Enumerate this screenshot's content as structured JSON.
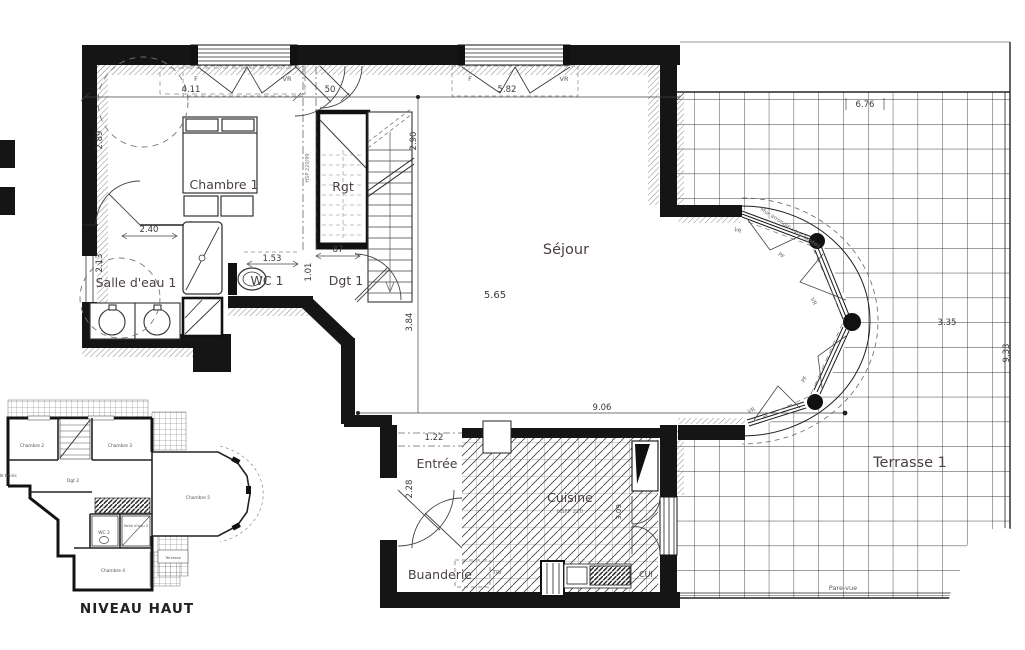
{
  "plan": {
    "rooms": {
      "chambre1": "Chambre 1",
      "rgt": "Rgt",
      "salle_eau": "Salle d'eau 1",
      "wc1": "WC 1",
      "dgt1": "Dgt 1",
      "sejour": "Séjour",
      "entree": "Entrée",
      "cuisine": "Cuisine",
      "buanderie": "Buanderie",
      "terrasse": "Terrasse 1"
    },
    "labels": {
      "hsfp": "HSFP 220",
      "tri": "TRI",
      "cui": "CUI",
      "pare_vue": "Pare-vue",
      "mur_arrondi": "Mur arrondie sans tapées",
      "hsp": "HSP 220/99",
      "f": "F",
      "vr": "VR",
      "pf": "PF"
    },
    "dims": {
      "w1": "4.11",
      "w2": "50",
      "w3": "5.82",
      "t1": "6.76",
      "left1": "2.89",
      "left2": "2.13",
      "sde": "2.40",
      "wc": "1.53",
      "dgt_w": "87",
      "dgt_h": "1.01",
      "stair": "2.90",
      "sej_h": "3.84",
      "sej_w": "5.65",
      "sej_b": "9.06",
      "ent_w": "1.22",
      "ent_h": "2.28",
      "cui_h": "3.09",
      "ter_w": "3.35",
      "ter_h": "9.33"
    }
  },
  "mini_plan": {
    "caption": "NIVEAU HAUT",
    "rooms": {
      "chambre2": "Chambre 2",
      "chambre3": "Chambre 3",
      "chambre4": "Chambre 4",
      "chambre5": "Chambre 5",
      "dgt2": "Dgt 2",
      "wc2": "WC 2",
      "salle_eau2": "Salle d'eau 2",
      "salle_bains": "Salle de bains",
      "terrasse": "Terrasse"
    }
  }
}
